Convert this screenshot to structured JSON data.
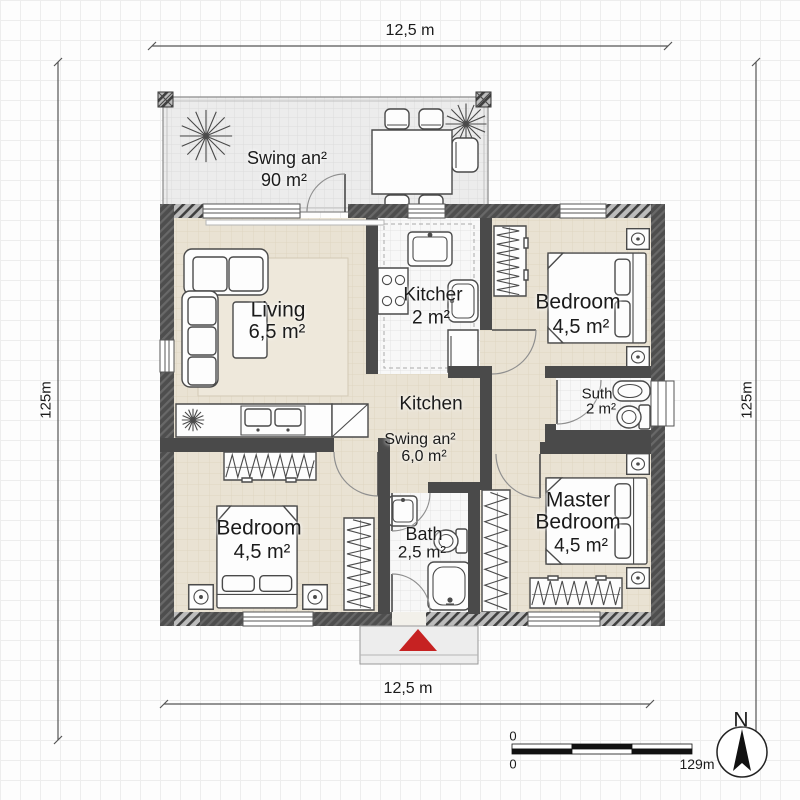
{
  "dimensions": {
    "top": "12,5 m",
    "bottom": "12,5 m",
    "left": "125m",
    "right": "125m"
  },
  "rooms": {
    "terrace": {
      "name": "Swing an²",
      "area": "90 m²"
    },
    "living": {
      "name": "Living",
      "area": "6,5 m²"
    },
    "kitchenette": {
      "name": "Kitcher",
      "area": "2 m²"
    },
    "bedroom_top_right": {
      "name": "Bedroom",
      "area": "4,5 m²"
    },
    "suth": {
      "name": "Suth",
      "area": "2 m²"
    },
    "hall": {
      "name": "Kitchen",
      "sub_name": "Swing an²",
      "sub_area": "6,0 m²"
    },
    "bedroom_bottom_left": {
      "name": "Bedroom",
      "area": "4,5 m²"
    },
    "bath": {
      "name": "Bath",
      "area": "2,5 m²"
    },
    "master_bedroom": {
      "name_line1": "Master",
      "name_line2": "Bedroom",
      "area": "4,5 m²"
    }
  },
  "scale_bar": {
    "zero_top": "0",
    "zero_bottom": "0",
    "max": "129m"
  },
  "compass": {
    "north": "N"
  },
  "colors": {
    "wall": "#4a4a4a",
    "floor_beige": "#e9e2d3",
    "tile_white": "#f8f8f8",
    "terrace_gray": "#ececec",
    "entry_marker_red": "#c62222"
  }
}
